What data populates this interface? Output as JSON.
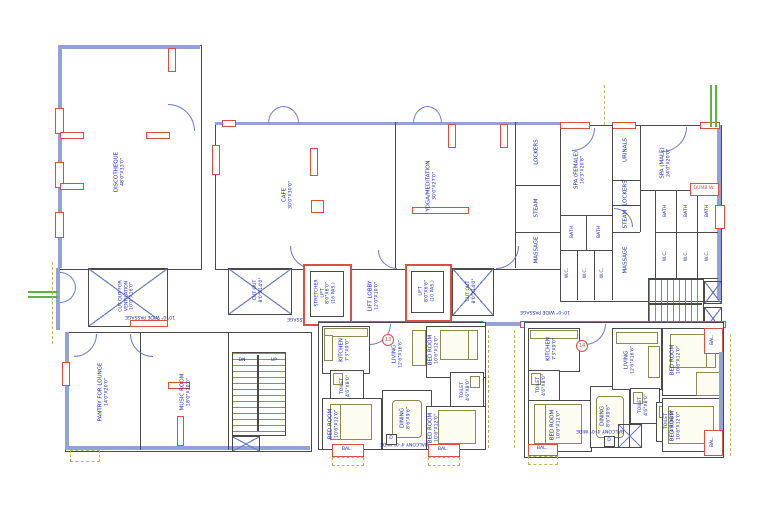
{
  "colors": {
    "wall_blue": "#93a2d8",
    "wall_red": "#d84f48",
    "text_navy": "#1b2aa6",
    "reference_green": "#59b63e",
    "furniture_olive": "#8a8a55"
  },
  "rooms": {
    "discotheque": {
      "name": "DISCOTHEQUE",
      "dim": "48'0\"X33'0\""
    },
    "cafe": {
      "name": "CAFE",
      "dim": "30'0\"X30'0\""
    },
    "yoga": {
      "name": "YOGA/MEDITATION",
      "dim": "30'0\"X27'0\""
    },
    "lockers": "LOCKERS",
    "steam": "STEAM",
    "massage": "MASSAGE",
    "bath": "BATH",
    "wc": "W.C.",
    "urinals": "URINALS",
    "spa_female": {
      "name": "SPA (FEMALE)",
      "dim": "16'3\"X20'8\""
    },
    "spa_male": {
      "name": "SPA (MALE)",
      "dim": "24'0\"X20'0\""
    },
    "dumb_waiter": "DUMB W.",
    "cutout_vent": {
      "name": "CUT OUT FOR",
      "name2": "VENTILATION",
      "dim": "10'0\"X16'0\""
    },
    "cutout": {
      "name": "CUT OUT",
      "dim": "8'0\"X14'0\""
    },
    "stretcher_lift": {
      "name": "STRETCHER",
      "name2": "LIFT",
      "dim": "8'0\"X8'0\"",
      "cap": "(16 PAS.)"
    },
    "lift": {
      "name": "LIFT",
      "dim": "8'0\"X6'6\"",
      "cap": "(10 PAS.)"
    },
    "lift_lobby": {
      "name": "LIFT LOBBY",
      "dim": "12'0\"X10'0\""
    },
    "passage": "10'-0\" WIDE PASSAGE",
    "pantry": {
      "name": "PANTRY FOR LOUNGE",
      "dim": "14'0\"X20'0\""
    },
    "music": {
      "name": "MUSIC ROOM",
      "dim": "18'0\"X20'0\""
    },
    "kitchen": {
      "name": "KITCHEN",
      "dim": "7'3\"X9'0\""
    },
    "living": {
      "name": "LIVING",
      "dim": "12'6\"X16'6\""
    },
    "dining": {
      "name": "DINING",
      "dim": "8'6\"X9'6\""
    },
    "toilet": {
      "name": "TOILET",
      "dim": "4'6\"X8'0\""
    },
    "bedroom": {
      "name": "BED ROOM",
      "dim": "10'6\"X12'0\""
    },
    "balcony_wide": "BALCONY 4'-0\" WIDE",
    "bal": "BAL.",
    "dn": "DN",
    "up": "UP",
    "d_marker": "D",
    "unit_left": "13",
    "unit_right": "14"
  }
}
